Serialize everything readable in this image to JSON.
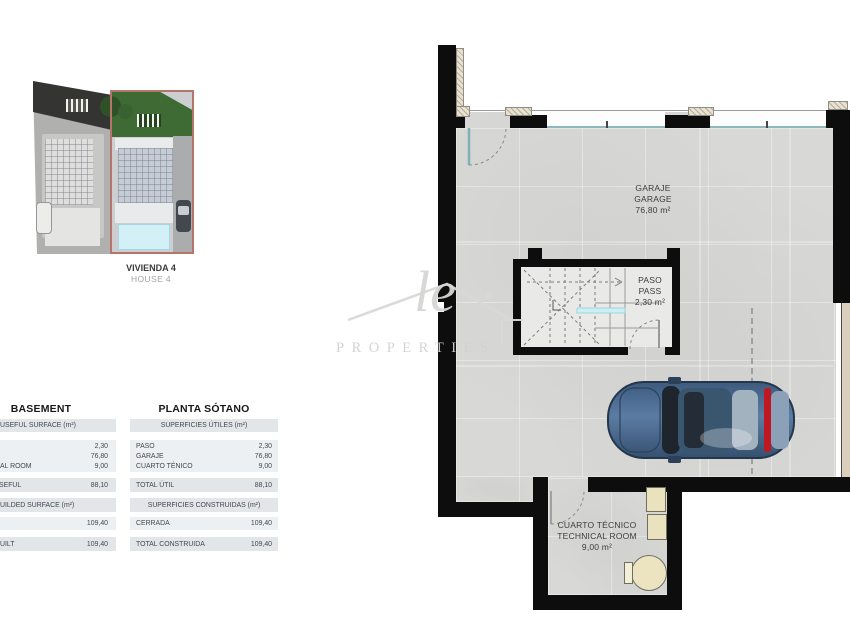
{
  "site_thumbnail": {
    "title": "VIVIENDA 4",
    "subtitle": "HOUSE 4",
    "highlight_color": "#b5756b",
    "pool_color": "#d3f0f7",
    "garden_color": "#3e6a33"
  },
  "tables": {
    "left": {
      "title": "BASEMENT",
      "header_useful": "USEFUL SURFACE (m²)",
      "rows_useful": [
        {
          "label": "",
          "value": "2,30"
        },
        {
          "label": "",
          "value": "76,80"
        },
        {
          "label": "AL ROOM",
          "value": "9,00"
        }
      ],
      "total_useful": {
        "label": "SEFUL",
        "value": "88,10"
      },
      "header_built": "UILDED SURFACE (m²)",
      "rows_built": [
        {
          "label": "",
          "value": "109,40"
        }
      ],
      "total_built": {
        "label": "UILT",
        "value": "109,40"
      }
    },
    "right": {
      "title": "PLANTA SÓTANO",
      "header_useful": "SUPERFICIES ÚTILES (m²)",
      "rows_useful": [
        {
          "label": "PASO",
          "value": "2,30"
        },
        {
          "label": "GARAJE",
          "value": "76,80"
        },
        {
          "label": "CUARTO TÉNICO",
          "value": "9,00"
        }
      ],
      "total_useful": {
        "label": "TOTAL ÚTIL",
        "value": "88,10"
      },
      "header_built": "SUPERFICIES CONSTRUIDAS (m²)",
      "rows_built": [
        {
          "label": "CERRADA",
          "value": "109,40"
        }
      ],
      "total_built": {
        "label": "TOTAL CONSTRUIDA",
        "value": "109,40"
      }
    }
  },
  "plan": {
    "garage": {
      "l1": "GARAJE",
      "l2": "GARAGE",
      "l3": "76,80 m²"
    },
    "paso": {
      "l1": "PASO",
      "l2": "PASS",
      "l3": "2,30 m²"
    },
    "tech": {
      "l1": "CUARTO TÉCNICO",
      "l2": "TECHNICAL ROOM",
      "l3": "9,00 m²"
    },
    "colors": {
      "wall": "#0d0d0d",
      "floor": "#d8d8d6",
      "glazing": "#8fb8bd",
      "car_body": "#4f6f95",
      "taillight": "#c01822",
      "equipment": "#eae1bf"
    }
  },
  "watermark": {
    "script": "le",
    "word": "PROPERTIES"
  }
}
